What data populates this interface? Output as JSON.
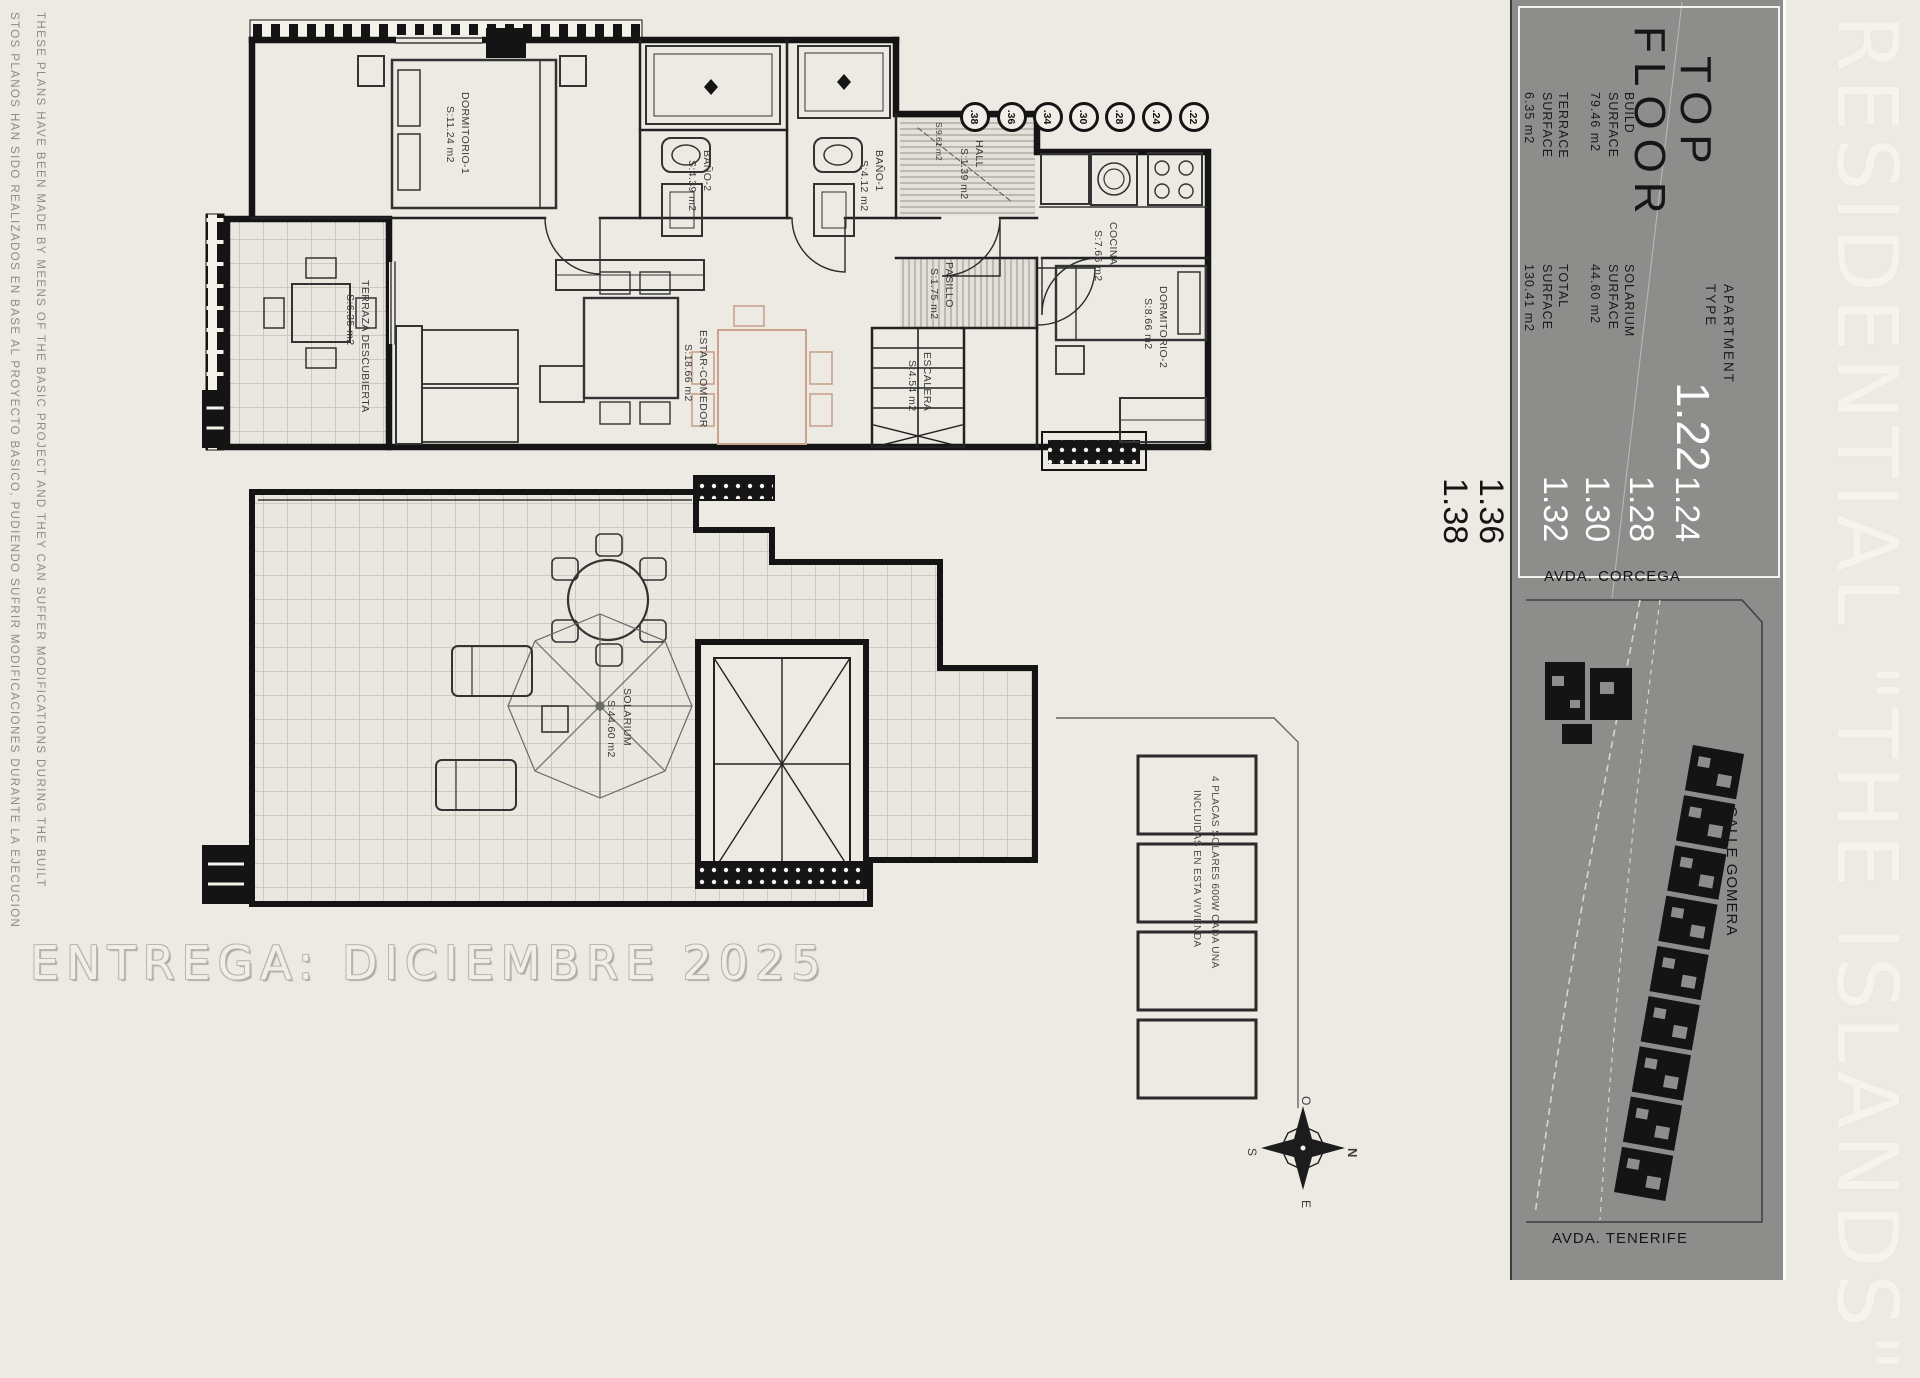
{
  "disclaimer": {
    "english": "THESE PLANS HAVE BEEN MADE BY MEENS OF THE BASIC PROJECT AND THEY CAN SUFFER MODIFICATIONS DURING THE BUILT",
    "spanish": "STOS PLANOS HAN SIDO REALIZADOS EN BASE AL PROYECTO BASICO, PUDIENDO SUFRIR MODIFICACIONES DURANTE LA EJECUCION"
  },
  "delivery_text": "ENTREGA: DICIEMBRE 2025",
  "residential_banner": "RESIDENTIAL \"THE ISLANDS\"",
  "info_panel": {
    "floor_line1": "TOP",
    "floor_line2": "FLOOR",
    "apartment_line1": "APARTMENT",
    "apartment_line2": "TYPE",
    "type_primary": "1.22",
    "white_numbers": [
      "1.24",
      "1.28",
      "1.30",
      "1.32"
    ],
    "black_numbers": [
      "1.36",
      "1.38"
    ],
    "metrics": [
      {
        "label1": "BUILD",
        "label2": "SURFACE",
        "value": "79.46 m2"
      },
      {
        "label1": "SOLARIUM",
        "label2": "SURFACE",
        "value": "44.60 m2"
      },
      {
        "label1": "TERRACE",
        "label2": "SURFACE",
        "value": "6.35 m2"
      },
      {
        "label1": "TOTAL",
        "label2": "SURFACE",
        "value": "130.41 m2"
      }
    ]
  },
  "site_plan": {
    "street_top": "AVDA. CORCEGA",
    "street_right": "CALLE GOMERA",
    "street_bottom": "AVDA. TENERIFE"
  },
  "compass": {
    "n": "N",
    "e": "E",
    "s": "S",
    "o": "O"
  },
  "unit_circles": [
    ".38",
    ".36",
    ".34",
    ".30",
    ".28",
    ".24",
    ".22"
  ],
  "rooms": {
    "dormitorio1": {
      "name": "DORMITORIO-1",
      "area": "S:11.24 m2"
    },
    "bano2": {
      "name": "BAÑO-2",
      "area": "S:4.39 m2"
    },
    "bano1": {
      "name": "BAÑO-1",
      "area": "S:4.12 m2"
    },
    "hall": {
      "name": "HALL",
      "area": "S:1.39 m2"
    },
    "hall_level": "S:9.61 m2",
    "cocina": {
      "name": "COCINA",
      "area": "S:7.66 m2"
    },
    "pasillo": {
      "name": "PASILLO",
      "area": "S:1.75 m2"
    },
    "escalera": {
      "name": "ESCALERA",
      "area": "S:4.54 m2"
    },
    "estar": {
      "name": "ESTAR-COMEDOR",
      "area": "S:18.66 m2"
    },
    "terraza": {
      "name": "TERRAZA DESCUBIERTA",
      "area": "S:6.35 m2"
    },
    "dormitorio2": {
      "name": "DORMITORIO-2",
      "area": "S:8.66 m2"
    },
    "solarium": {
      "name": "SOLARIUM",
      "area": "S:44.60 m2"
    }
  },
  "solar_note": {
    "line1": "4 PLACAS SOLARES 600W CADA UNA",
    "line2": "INCLUIDAS EN ESTA VIVIENDA"
  },
  "colors": {
    "background": "#eceae3",
    "panel_gray": "#8d8d8c",
    "line_black": "#141414",
    "accent_tan": "#c9a18c"
  }
}
